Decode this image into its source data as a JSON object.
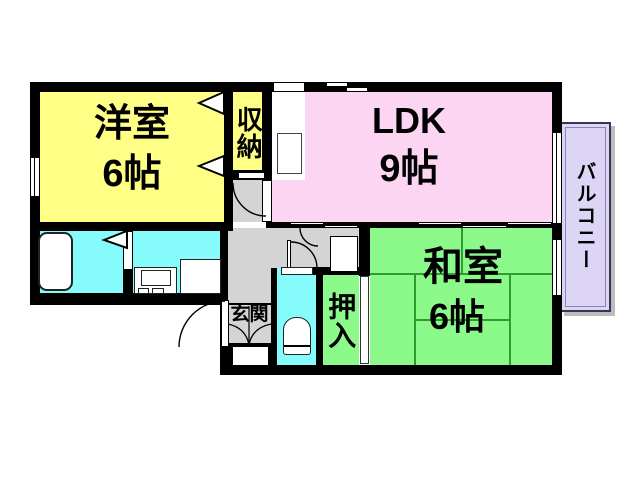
{
  "rooms": {
    "western": {
      "name": "洋室",
      "size": "6帖",
      "color": "#ffff85"
    },
    "storage": {
      "name": "収納",
      "color": "#ffff85"
    },
    "ldk": {
      "name": "LDK",
      "size": "9帖",
      "color": "#fbd5f2"
    },
    "japanese": {
      "name": "和室",
      "size": "6帖",
      "color": "#8bfa8b"
    },
    "closet": {
      "name": "押入",
      "color": "#8bfa8b"
    },
    "entrance": {
      "name": "玄関",
      "color": "#d4d4d4"
    },
    "balcony": {
      "name": "バルコニー",
      "color": "#ddd5f5"
    },
    "bathroom": {
      "color": "#85fbfb"
    },
    "washroom": {
      "color": "#85fbfb"
    },
    "toilet": {
      "color": "#85fbfb"
    },
    "hallway": {
      "color": "#d4d4d4"
    }
  },
  "colors": {
    "wall": "#000000",
    "tatami_line": "#2f9e2f",
    "background": "#ffffff",
    "balcony_shadow": "#bdbdbd"
  }
}
